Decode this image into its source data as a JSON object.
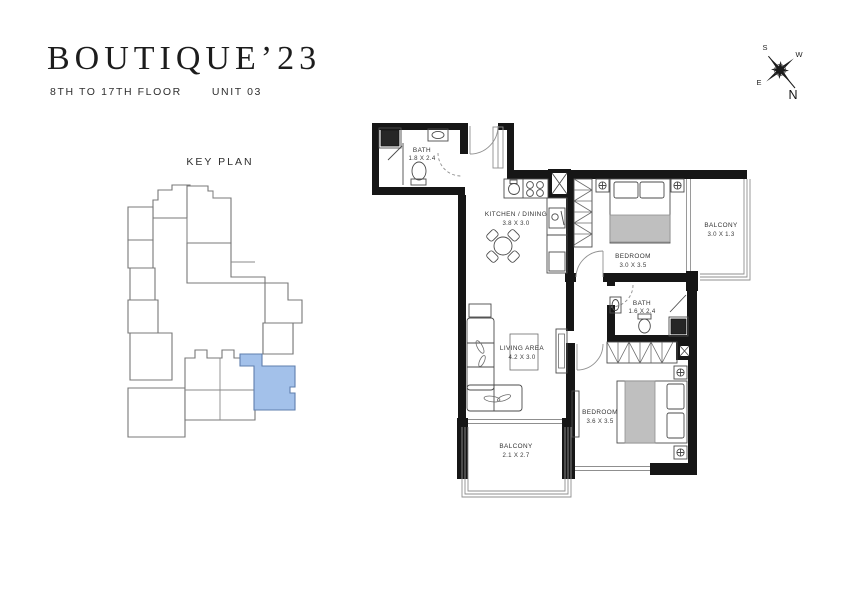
{
  "brand": {
    "name": "BOUTIQUE’23",
    "floor_range": "8TH TO 17TH FLOOR",
    "unit": "UNIT 03"
  },
  "compass": {
    "n": "N",
    "s": "S",
    "e": "E",
    "w": "W"
  },
  "key_plan": {
    "title": "KEY PLAN",
    "highlight_color": "#a3c1ea",
    "highlight_stroke": "#5f7fae"
  },
  "floor_plan": {
    "rooms": [
      {
        "name": "BATH",
        "dims": "1.8 X 2.4"
      },
      {
        "name": "KITCHEN / DINING",
        "dims": "3.8 X 3.0"
      },
      {
        "name": "BEDROOM",
        "dims": "3.0 X 3.5"
      },
      {
        "name": "BALCONY",
        "dims": "3.0 X 1.3"
      },
      {
        "name": "BATH",
        "dims": "1.6 X 2.4"
      },
      {
        "name": "LIVING AREA",
        "dims": "4.2 X 3.0"
      },
      {
        "name": "BEDROOM",
        "dims": "3.6 X 3.5"
      },
      {
        "name": "BALCONY",
        "dims": "2.1 X 2.7"
      }
    ]
  }
}
